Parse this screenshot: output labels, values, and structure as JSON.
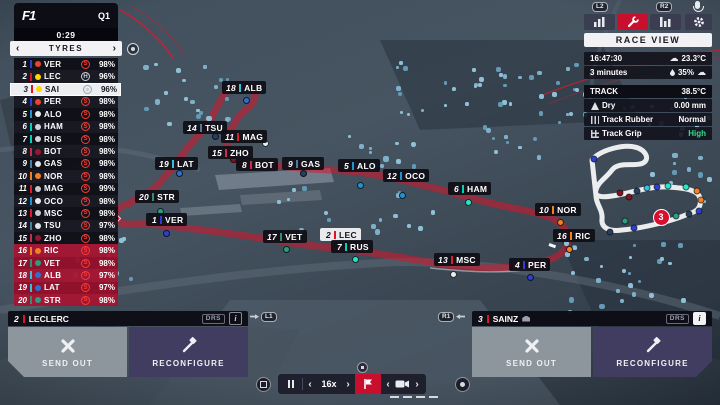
{
  "colors": {
    "accent_red": "#c8102e",
    "grip_high": "#2fe08a",
    "selected_row": "#edeef2",
    "danger_row": "#a01430"
  },
  "teams": {
    "redbull": {
      "bar": "#2e3fd1",
      "dot": "#2e3fd1",
      "logo": "#e8452d"
    },
    "ferrari": {
      "bar": "#e81123",
      "dot": "#c00a1e",
      "logo": "#ffd800"
    },
    "mercedes": {
      "bar": "#00d2be",
      "dot": "#27e6c8",
      "logo": "#cfd4d8"
    },
    "alpine": {
      "bar": "#2293d1",
      "dot": "#2293d1",
      "logo": "#e8ecef"
    },
    "mclaren": {
      "bar": "#f58020",
      "dot": "#f58020",
      "logo": "#f58020"
    },
    "alfa": {
      "bar": "#c92d4b",
      "dot": "#8a1020",
      "logo": "#9b1530"
    },
    "alphatauri": {
      "bar": "#4e7c9b",
      "dot": "#27405e",
      "logo": "#dfe6ea"
    },
    "haas": {
      "bar": "#e01a30",
      "dot": "#eceff1",
      "logo": "#c8ccd0"
    },
    "aston": {
      "bar": "#358c75",
      "dot": "#2f9b7f",
      "logo": "#2f9b7f"
    },
    "williams": {
      "bar": "#37bedd",
      "dot": "#2f6fd0",
      "logo": "#2f6fd0"
    }
  },
  "session": {
    "logo": "F1",
    "round": "Q1",
    "timer": "0:29"
  },
  "tyres_panel": {
    "title": "TYRES"
  },
  "glyphs": {
    "prev": "‹",
    "next": "›"
  },
  "standings": [
    {
      "pos": "1",
      "code": "VER",
      "team": "redbull",
      "tyre": "S",
      "pct": "98%",
      "state": "normal"
    },
    {
      "pos": "2",
      "code": "LEC",
      "team": "ferrari",
      "tyre": "H",
      "pct": "96%",
      "state": "normal"
    },
    {
      "pos": "3",
      "code": "SAI",
      "team": "ferrari",
      "tyre": "wheel",
      "pct": "96%",
      "state": "selected"
    },
    {
      "pos": "4",
      "code": "PER",
      "team": "redbull",
      "tyre": "S",
      "pct": "98%",
      "state": "normal"
    },
    {
      "pos": "5",
      "code": "ALO",
      "team": "alpine",
      "tyre": "S",
      "pct": "98%",
      "state": "normal"
    },
    {
      "pos": "6",
      "code": "HAM",
      "team": "mercedes",
      "tyre": "S",
      "pct": "98%",
      "state": "normal"
    },
    {
      "pos": "7",
      "code": "RUS",
      "team": "mercedes",
      "tyre": "S",
      "pct": "98%",
      "state": "normal"
    },
    {
      "pos": "8",
      "code": "BOT",
      "team": "alfa",
      "tyre": "S",
      "pct": "98%",
      "state": "normal"
    },
    {
      "pos": "9",
      "code": "GAS",
      "team": "alphatauri",
      "tyre": "S",
      "pct": "98%",
      "state": "normal"
    },
    {
      "pos": "10",
      "code": "NOR",
      "team": "mclaren",
      "tyre": "S",
      "pct": "98%",
      "state": "normal"
    },
    {
      "pos": "11",
      "code": "MAG",
      "team": "haas",
      "tyre": "S",
      "pct": "99%",
      "state": "normal"
    },
    {
      "pos": "12",
      "code": "OCO",
      "team": "alpine",
      "tyre": "S",
      "pct": "98%",
      "state": "normal"
    },
    {
      "pos": "13",
      "code": "MSC",
      "team": "haas",
      "tyre": "S",
      "pct": "98%",
      "state": "normal"
    },
    {
      "pos": "14",
      "code": "TSU",
      "team": "alphatauri",
      "tyre": "S",
      "pct": "97%",
      "state": "normal"
    },
    {
      "pos": "15",
      "code": "ZHO",
      "team": "alfa",
      "tyre": "S",
      "pct": "98%",
      "state": "normal"
    },
    {
      "pos": "16",
      "code": "RIC",
      "team": "mclaren",
      "tyre": "S",
      "pct": "98%",
      "state": "danger"
    },
    {
      "pos": "17",
      "code": "VET",
      "team": "aston",
      "tyre": "S",
      "pct": "98%",
      "state": "danger"
    },
    {
      "pos": "18",
      "code": "ALB",
      "team": "williams",
      "tyre": "S",
      "pct": "97%",
      "state": "danger"
    },
    {
      "pos": "19",
      "code": "LAT",
      "team": "williams",
      "tyre": "S",
      "pct": "97%",
      "state": "danger"
    },
    {
      "pos": "20",
      "code": "STR",
      "team": "aston",
      "tyre": "S",
      "pct": "98%",
      "state": "danger"
    }
  ],
  "view_bar": {
    "hint_left": "L2",
    "hint_right": "R2"
  },
  "race_view_label": "RACE VIEW",
  "weather": {
    "clock": "16:47:30",
    "air_temp": "23.3°C",
    "time_left": "3 minutes",
    "humidity": "35%"
  },
  "track": {
    "title": "TRACK",
    "temp": "38.5°C",
    "rows": [
      {
        "icon": "dry-warning-icon",
        "label": "Dry",
        "value": "0.00 mm"
      },
      {
        "icon": "track-rubber-icon",
        "label": "Track Rubber",
        "value": "Normal"
      },
      {
        "icon": "track-grip-icon",
        "label": "Track Grip",
        "value": "High",
        "highlight": "green"
      }
    ]
  },
  "map": {
    "tags": [
      {
        "pos": "18",
        "code": "ALB",
        "team": "williams",
        "x": 222,
        "y": 81
      },
      {
        "pos": "14",
        "code": "TSU",
        "team": "alphatauri",
        "x": 183,
        "y": 121
      },
      {
        "pos": "11",
        "code": "MAG",
        "team": "haas",
        "x": 221,
        "y": 130
      },
      {
        "pos": "15",
        "code": "ZHO",
        "team": "alfa",
        "x": 208,
        "y": 146
      },
      {
        "pos": "8",
        "code": "BOT",
        "team": "alfa",
        "x": 236,
        "y": 158
      },
      {
        "pos": "9",
        "code": "GAS",
        "team": "alphatauri",
        "x": 282,
        "y": 157
      },
      {
        "pos": "5",
        "code": "ALO",
        "team": "alpine",
        "x": 338,
        "y": 159
      },
      {
        "pos": "12",
        "code": "OCO",
        "team": "alpine",
        "x": 383,
        "y": 169
      },
      {
        "pos": "6",
        "code": "HAM",
        "team": "mercedes",
        "x": 448,
        "y": 182
      },
      {
        "pos": "19",
        "code": "LAT",
        "team": "williams",
        "x": 155,
        "y": 157
      },
      {
        "pos": "20",
        "code": "STR",
        "team": "aston",
        "x": 135,
        "y": 190
      },
      {
        "pos": "1",
        "code": "VER",
        "team": "redbull",
        "x": 146,
        "y": 213
      },
      {
        "pos": "17",
        "code": "VET",
        "team": "aston",
        "x": 263,
        "y": 230
      },
      {
        "pos": "2",
        "code": "LEC",
        "team": "ferrari",
        "x": 320,
        "y": 228,
        "highlight": true
      },
      {
        "pos": "7",
        "code": "RUS",
        "team": "mercedes",
        "x": 331,
        "y": 240
      },
      {
        "pos": "10",
        "code": "NOR",
        "team": "mclaren",
        "x": 535,
        "y": 203
      },
      {
        "pos": "16",
        "code": "RIC",
        "team": "mclaren",
        "x": 553,
        "y": 229
      },
      {
        "pos": "13",
        "code": "MSC",
        "team": "haas",
        "x": 434,
        "y": 253
      },
      {
        "pos": "4",
        "code": "PER",
        "team": "redbull",
        "x": 509,
        "y": 258
      }
    ],
    "cars": [
      {
        "x": 243,
        "y": 97,
        "team": "williams"
      },
      {
        "x": 212,
        "y": 133,
        "team": "alphatauri"
      },
      {
        "x": 262,
        "y": 140,
        "team": "haas"
      },
      {
        "x": 230,
        "y": 156,
        "team": "alfa"
      },
      {
        "x": 237,
        "y": 161,
        "team": "alfa"
      },
      {
        "x": 300,
        "y": 170,
        "team": "alphatauri"
      },
      {
        "x": 357,
        "y": 182,
        "team": "alpine"
      },
      {
        "x": 399,
        "y": 192,
        "team": "alpine"
      },
      {
        "x": 465,
        "y": 199,
        "team": "mercedes"
      },
      {
        "x": 176,
        "y": 170,
        "team": "williams"
      },
      {
        "x": 157,
        "y": 208,
        "team": "aston"
      },
      {
        "x": 163,
        "y": 230,
        "team": "redbull"
      },
      {
        "x": 283,
        "y": 246,
        "team": "aston"
      },
      {
        "x": 352,
        "y": 256,
        "team": "mercedes"
      },
      {
        "x": 557,
        "y": 219,
        "team": "mclaren"
      },
      {
        "x": 566,
        "y": 246,
        "team": "mclaren"
      },
      {
        "x": 450,
        "y": 271,
        "team": "haas"
      },
      {
        "x": 527,
        "y": 274,
        "team": "redbull"
      }
    ],
    "flag_marker": {
      "x": 108,
      "y": 213
    }
  },
  "minimap": {
    "selected": {
      "label": "3",
      "x": 661,
      "y": 217
    },
    "dots": [
      {
        "x": 594,
        "y": 159,
        "c": "#2e3fd1"
      },
      {
        "x": 620,
        "y": 193,
        "c": "#8a1020"
      },
      {
        "x": 629,
        "y": 197,
        "c": "#8a1020"
      },
      {
        "x": 637,
        "y": 191,
        "c": "#27405e"
      },
      {
        "x": 647,
        "y": 188,
        "c": "#37bedd"
      },
      {
        "x": 657,
        "y": 187,
        "c": "#2e3fd1"
      },
      {
        "x": 668,
        "y": 186,
        "c": "#27e6c8"
      },
      {
        "x": 686,
        "y": 187,
        "c": "#27e6c8"
      },
      {
        "x": 697,
        "y": 191,
        "c": "#f58020"
      },
      {
        "x": 701,
        "y": 200,
        "c": "#f58020"
      },
      {
        "x": 699,
        "y": 211,
        "c": "#2e3fd1"
      },
      {
        "x": 689,
        "y": 214,
        "c": "#27405e"
      },
      {
        "x": 676,
        "y": 216,
        "c": "#2f9b7f"
      },
      {
        "x": 625,
        "y": 221,
        "c": "#2f9b7f"
      },
      {
        "x": 634,
        "y": 228,
        "c": "#2e3fd1"
      },
      {
        "x": 610,
        "y": 232,
        "c": "#27405e"
      }
    ]
  },
  "driver_panels": {
    "left": {
      "pos": "2",
      "name": "LECLERC",
      "drs": "DRS",
      "info": "i",
      "send_out": "SEND OUT",
      "reconfigure": "RECONFIGURE",
      "hint": "L1"
    },
    "right": {
      "pos": "3",
      "name": "SAINZ",
      "drs": "DRS",
      "info": "i",
      "send_out": "SEND OUT",
      "reconfigure": "RECONFIGURE",
      "hint": "R1"
    }
  },
  "playback": {
    "speed": "16x"
  }
}
